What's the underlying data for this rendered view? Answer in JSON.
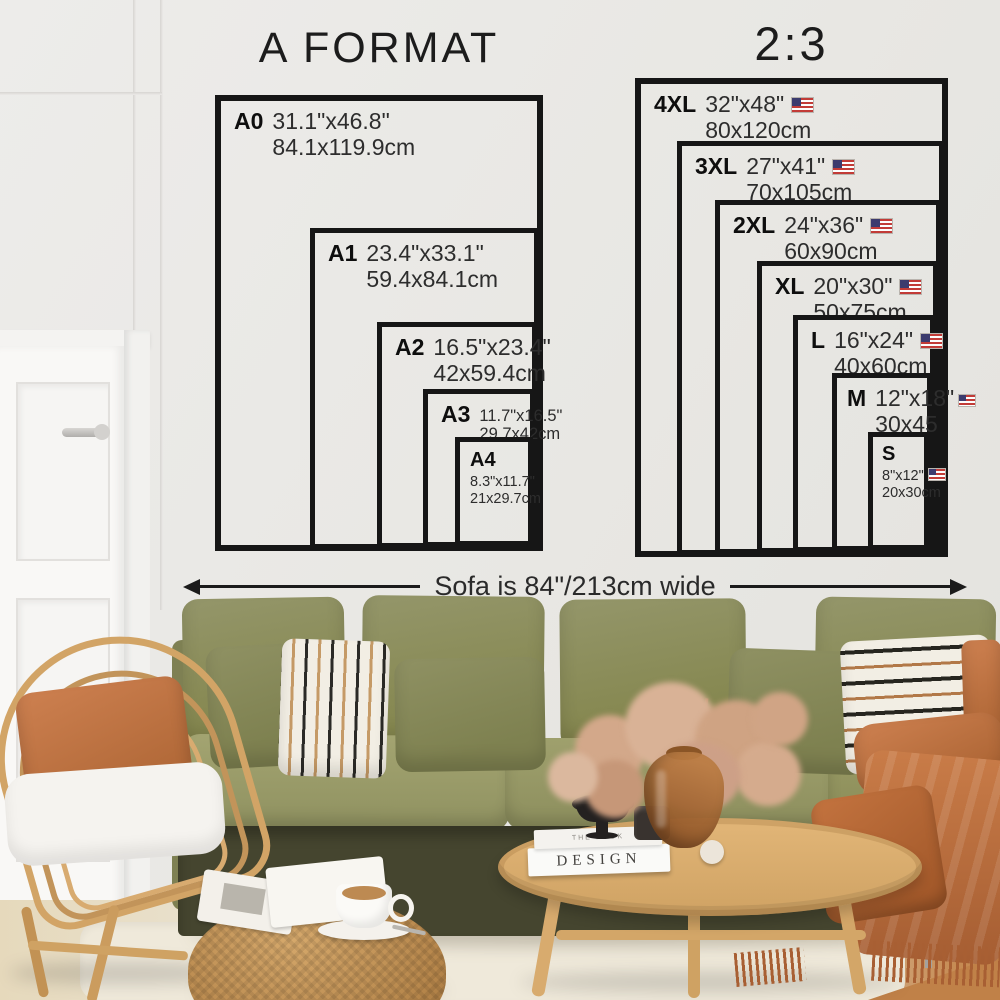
{
  "a_format": {
    "title": "A FORMAT",
    "sizes": [
      {
        "label": "A0",
        "inches": "31.1\"x46.8\"",
        "cm": "84.1x119.9cm"
      },
      {
        "label": "A1",
        "inches": "23.4\"x33.1\"",
        "cm": "59.4x84.1cm"
      },
      {
        "label": "A2",
        "inches": "16.5\"x23.4\"",
        "cm": "42x59.4cm"
      },
      {
        "label": "A3",
        "inches": "11.7\"x16.5\"",
        "cm": "29.7x42cm"
      },
      {
        "label": "A4",
        "inches": "8.3\"x11.7\"",
        "cm": "21x29.7cm"
      }
    ]
  },
  "ratio_2_3": {
    "title": "2:3",
    "sizes": [
      {
        "label": "4XL",
        "inches": "32\"x48\"",
        "cm": "80x120cm",
        "flag": "us-flag-icon"
      },
      {
        "label": "3XL",
        "inches": "27\"x41\"",
        "cm": "70x105cm",
        "flag": "us-flag-icon"
      },
      {
        "label": "2XL",
        "inches": "24\"x36\"",
        "cm": "60x90cm",
        "flag": "us-flag-icon"
      },
      {
        "label": "XL",
        "inches": "20\"x30\"",
        "cm": "50x75cm",
        "flag": "us-flag-icon"
      },
      {
        "label": "L",
        "inches": "16\"x24\"",
        "cm": "40x60cm",
        "flag": "us-flag-icon"
      },
      {
        "label": "M",
        "inches": "12\"x18\"",
        "cm": "30x45",
        "flag": "us-flag-icon"
      },
      {
        "label": "S",
        "inches": "8\"x12\"",
        "cm": "20x30cm",
        "flag": "us-flag-icon"
      }
    ]
  },
  "annotation": {
    "sofa_width": "Sofa is 84\"/213cm wide"
  },
  "props": {
    "book_title": "DESIGN",
    "book_subtitle": "THE BOOK"
  },
  "colors": {
    "poster_ink": "#161616",
    "wall": "#e8e7e3",
    "sofa_olive": "#8c8e5f",
    "rust": "#bd7245",
    "rattan": "#d2a466",
    "wood_floor": "#c08148"
  }
}
